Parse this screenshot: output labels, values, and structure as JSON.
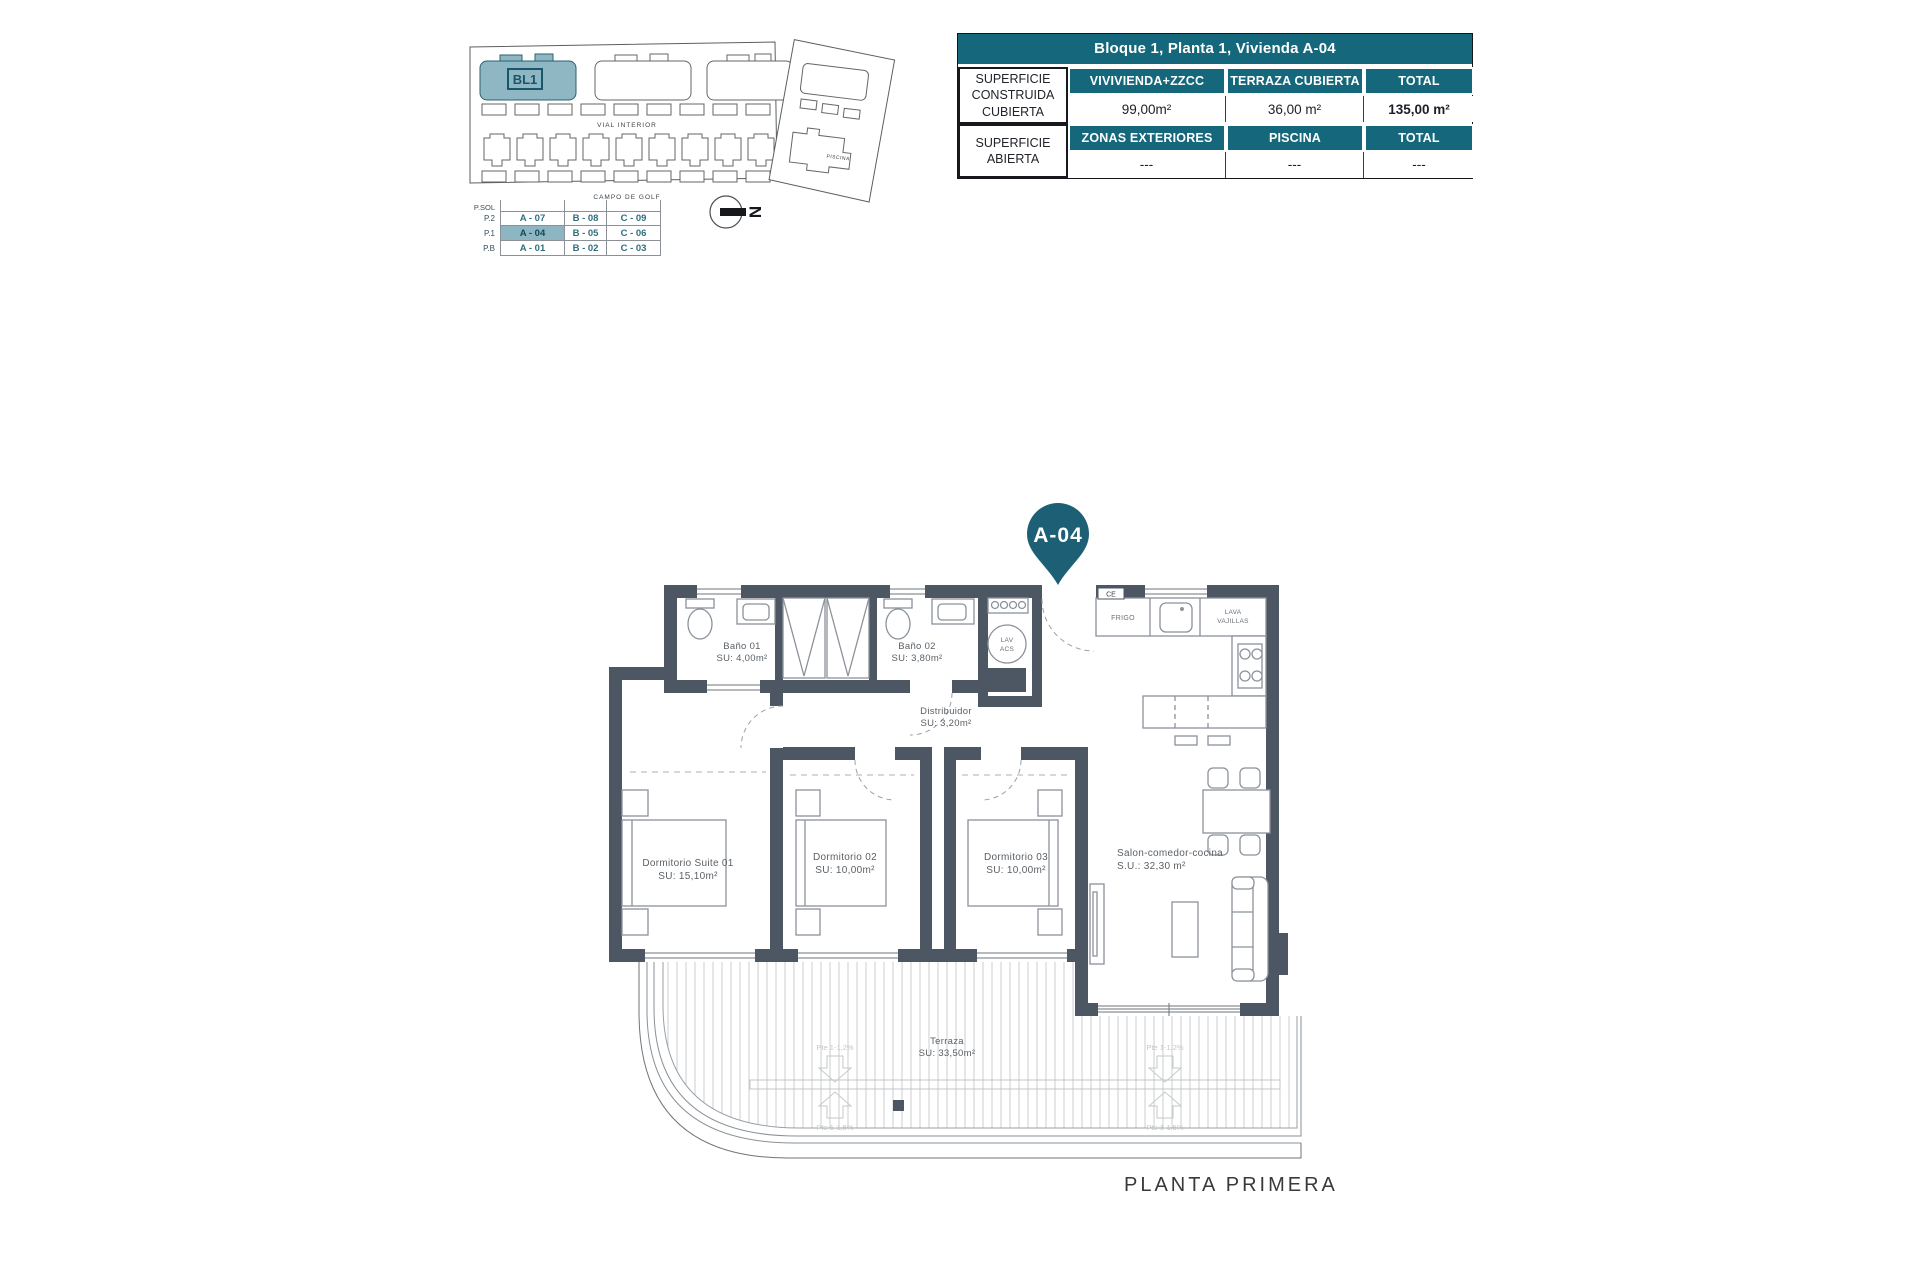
{
  "site_plan": {
    "bl1": "BL1",
    "vial_interior": "VIAL INTERIOR",
    "campo_de_golf": "CAMPO DE GOLF",
    "piscina": "PISCINA"
  },
  "north": {
    "label": "N"
  },
  "levels_table": {
    "row_labels": [
      "P.SOL",
      "P.2",
      "P.1",
      "P.B"
    ],
    "rows": [
      [
        "",
        "",
        ""
      ],
      [
        "A - 07",
        "B - 08",
        "C - 09"
      ],
      [
        "A - 04",
        "B - 05",
        "C - 06"
      ],
      [
        "A - 01",
        "B - 02",
        "C - 03"
      ]
    ],
    "highlighted_unit": "A - 04"
  },
  "info_table": {
    "title": "Bloque 1, Planta 1, Vivienda A-04",
    "groups": [
      {
        "row_label": "SUPERFICIE CONSTRUIDA CUBIERTA",
        "columns": [
          "VIVIVIENDA+ZZCC",
          "TERRAZA CUBIERTA",
          "TOTAL"
        ],
        "values": [
          "99,00m²",
          "36,00 m²",
          "135,00 m²"
        ]
      },
      {
        "row_label": "SUPERFICIE ABIERTA",
        "columns": [
          "ZONAS EXTERIORES",
          "PISCINA",
          "TOTAL"
        ],
        "values": [
          "---",
          "---",
          "---"
        ]
      }
    ]
  },
  "pin": {
    "label": "A-04"
  },
  "floor_plan": {
    "rooms": [
      {
        "name": "Baño 01",
        "area": "SU: 4,00m²"
      },
      {
        "name": "Baño 02",
        "area": "SU: 3,80m²"
      },
      {
        "name": "Distribuidor",
        "area": "SU: 3,20m²"
      },
      {
        "name": "Dormitorio Suite 01",
        "area": "SU: 15,10m²"
      },
      {
        "name": "Dormitorio 02",
        "area": "SU: 10,00m²"
      },
      {
        "name": "Dormitorio 03",
        "area": "SU: 10,00m²"
      },
      {
        "name": "Salon-comedor-cocina",
        "area": "S.U.: 32,30 m²"
      },
      {
        "name": "Terraza",
        "area": "SU: 33,50m²"
      }
    ],
    "labels": {
      "frigo": "FRIGO",
      "lava_line1": "LAVA",
      "lava_line2": "VAJILLAS",
      "lav": "LAV",
      "acs": "ACS",
      "ce": "CE"
    },
    "slopes": {
      "upper": "Pte 1-1,2%",
      "lower": "Pte 1-1,5%"
    }
  },
  "footer": {
    "label": "PLANTA PRIMERA"
  },
  "colors": {
    "teal": "#15687b",
    "wall": "#4d5663",
    "highlight": "#8db6c2",
    "pin": "#1d5f75"
  }
}
